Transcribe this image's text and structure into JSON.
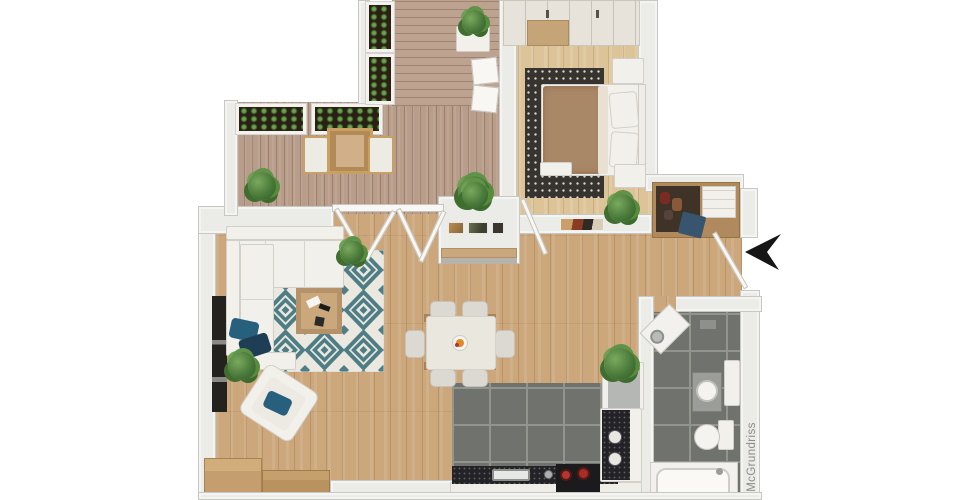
{
  "watermark": {
    "label": "McGrundriss"
  },
  "icons": {
    "north_arrow": "left-pointing-compass-arrow"
  },
  "palette": {
    "background": "#ffffff",
    "wall": "#ebebe8",
    "living_wood": "#cba77b",
    "bedroom_wood": "#dcc398",
    "terrace_deck": "#b89d8b",
    "tile_gray": "#70726d",
    "rug_teal": "#4e7d85",
    "rug_cream": "#eae8df",
    "pillow_blue": "#26607d",
    "duvet_brown": "#a98868",
    "counter_black": "#232327",
    "pot_red": "#b23530",
    "plant_green": "#4a7a3a",
    "watermark_gray": "#8a8a8a",
    "arrow_black": "#161616"
  }
}
